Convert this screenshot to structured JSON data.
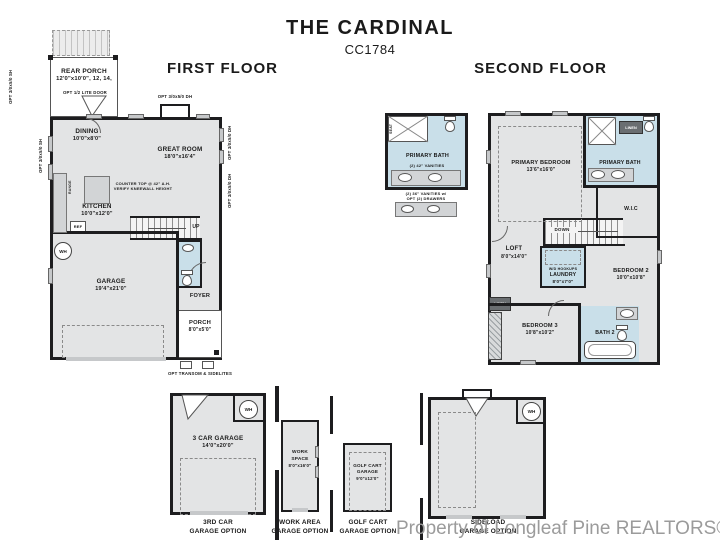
{
  "header": {
    "title": "THE CARDINAL",
    "plan": "CC1784"
  },
  "sections": {
    "first": "FIRST FLOOR",
    "second": "SECOND FLOOR"
  },
  "ff": {
    "rear_porch_name": "REAR PORCH",
    "rear_porch_dims": "12'0\"x10'0\", 12, 14,",
    "opt_door": "OPT 1/2 LITE DOOR",
    "win_sh": "OPT 3/0x5/0 SH",
    "win_dh": "OPT 3/0x5/0 DH",
    "dining_name": "DINING",
    "dining_dims": "10'0\"x8'0\"",
    "great_name": "GREAT ROOM",
    "great_dims": "18'0\"x16'4\"",
    "kitchen_name": "KITCHEN",
    "kitchen_dims": "10'0\"x12'0\"",
    "counter_note_1": "COUNTER TOP @ 42\" A.H.",
    "counter_note_2": "VERIFY KNEEWALL HEIGHT",
    "range": "RANGE",
    "dw": "DW",
    "ref": "REF",
    "wh": "WH",
    "up": "UP",
    "garage_name": "GARAGE",
    "garage_dims": "19'4\"x21'0\"",
    "foyer": "FOYER",
    "porch_name": "PORCH",
    "porch_dims": "8'0\"x5'0\"",
    "transom": "OPT TRANSOM & SIDELITES"
  },
  "sf": {
    "opt_bath_name": "PRIMARY BATH",
    "seat": "SEAT",
    "vanities_42": "(2) 42\" VANITIES",
    "vanities_36_1": "(2) 36\" VANITIES w/",
    "vanities_36_2": "OPT (2) DRAWERS",
    "primary_bedroom_name": "PRIMARY BEDROOM",
    "primary_bedroom_dims": "13'6\"x16'0\"",
    "primary_bath_name": "PRIMARY BATH",
    "linen": "LINEN",
    "wic": "W.I.C",
    "down": "DOWN",
    "loft_name": "LOFT",
    "loft_dims": "8'0\"x14'0\"",
    "wd": "W/D HOOKUPS",
    "laundry_name": "LAUNDRY",
    "laundry_dims": "8'0\"x7'0\"",
    "bedroom2_name": "BEDROOM 2",
    "bedroom2_dims": "10'0\"x10'8\"",
    "bedroom3_name": "BEDROOM 3",
    "bedroom3_dims": "10'8\"x10'2\"",
    "bath2": "BATH 2",
    "wh": "WH"
  },
  "opts": {
    "a_name": "3 CAR GARAGE",
    "a_dims": "14'0\"x20'0\"",
    "a_cap1": "3RD CAR",
    "a_cap2": "GARAGE OPTION",
    "a_wh": "WH",
    "b_name1": "WORK",
    "b_name2": "SPACE",
    "b_dims": "8'0\"x16'0\"",
    "b_cap1": "WORK AREA",
    "b_cap2": "GARAGE OPTION",
    "c_name1": "GOLF CART",
    "c_name2": "GARAGE",
    "c_dims": "9'0\"x12'0\"",
    "c_cap1": "GOLF CART",
    "c_cap2": "GARAGE OPTION",
    "d_cap1": "SIDELOAD",
    "d_cap2": "GARAGE OPTION",
    "d_wh": "WH"
  },
  "watermark": "Property of Longleaf Pine REALTORS® 2025"
}
